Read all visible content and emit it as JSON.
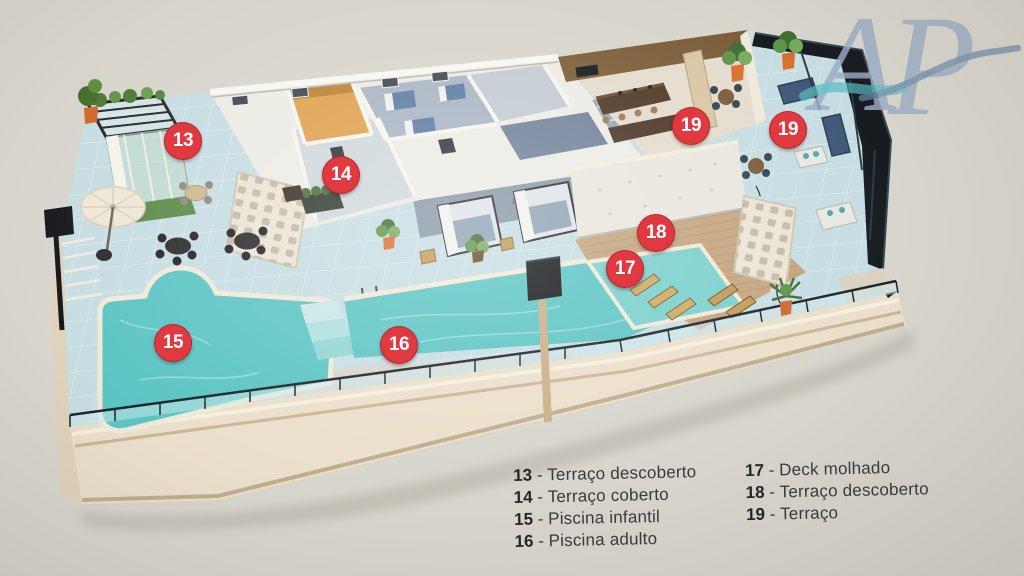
{
  "colors": {
    "background": "#d8d5cd",
    "marker_red": "#e03a40",
    "marker_text": "#ffffff",
    "legend_number": "#262626",
    "legend_text": "#3a3a3a",
    "tile_floor": "#c6dde2",
    "pool_water": "#5cc5c3",
    "wet_deck_water": "#7ad0cc",
    "wood_deck": "#c4a47e",
    "facade_cream": "#eadfca",
    "wall_white": "#edebe4",
    "kitchen_wood": "#7c5c38",
    "closet_orange": "#e0a14e",
    "railing_dark": "#171c21",
    "logo_letters": "#9badc4",
    "logo_wave_teal": "#56bcc2",
    "logo_wave_blue": "#6d88a8"
  },
  "logo": {
    "letter_a": "A",
    "letter_p": "P"
  },
  "markers": {
    "m13": {
      "number": "13"
    },
    "m14": {
      "number": "14"
    },
    "m15": {
      "number": "15"
    },
    "m16": {
      "number": "16"
    },
    "m17": {
      "number": "17"
    },
    "m18": {
      "number": "18"
    },
    "m19a": {
      "number": "19"
    },
    "m19b": {
      "number": "19"
    }
  },
  "legend": {
    "separator_display": " - ",
    "col1": {
      "items": [
        {
          "number": "13",
          "label": "Terraço descoberto"
        },
        {
          "number": "14",
          "label": "Terraço coberto"
        },
        {
          "number": "15",
          "label": "Piscina infantil"
        },
        {
          "number": "16",
          "label": "Piscina adulto"
        }
      ]
    },
    "col2": {
      "items": [
        {
          "number": "17",
          "label": "Deck molhado"
        },
        {
          "number": "18",
          "label": "Terraço descoberto"
        },
        {
          "number": "19",
          "label": "Terraço"
        }
      ]
    }
  }
}
